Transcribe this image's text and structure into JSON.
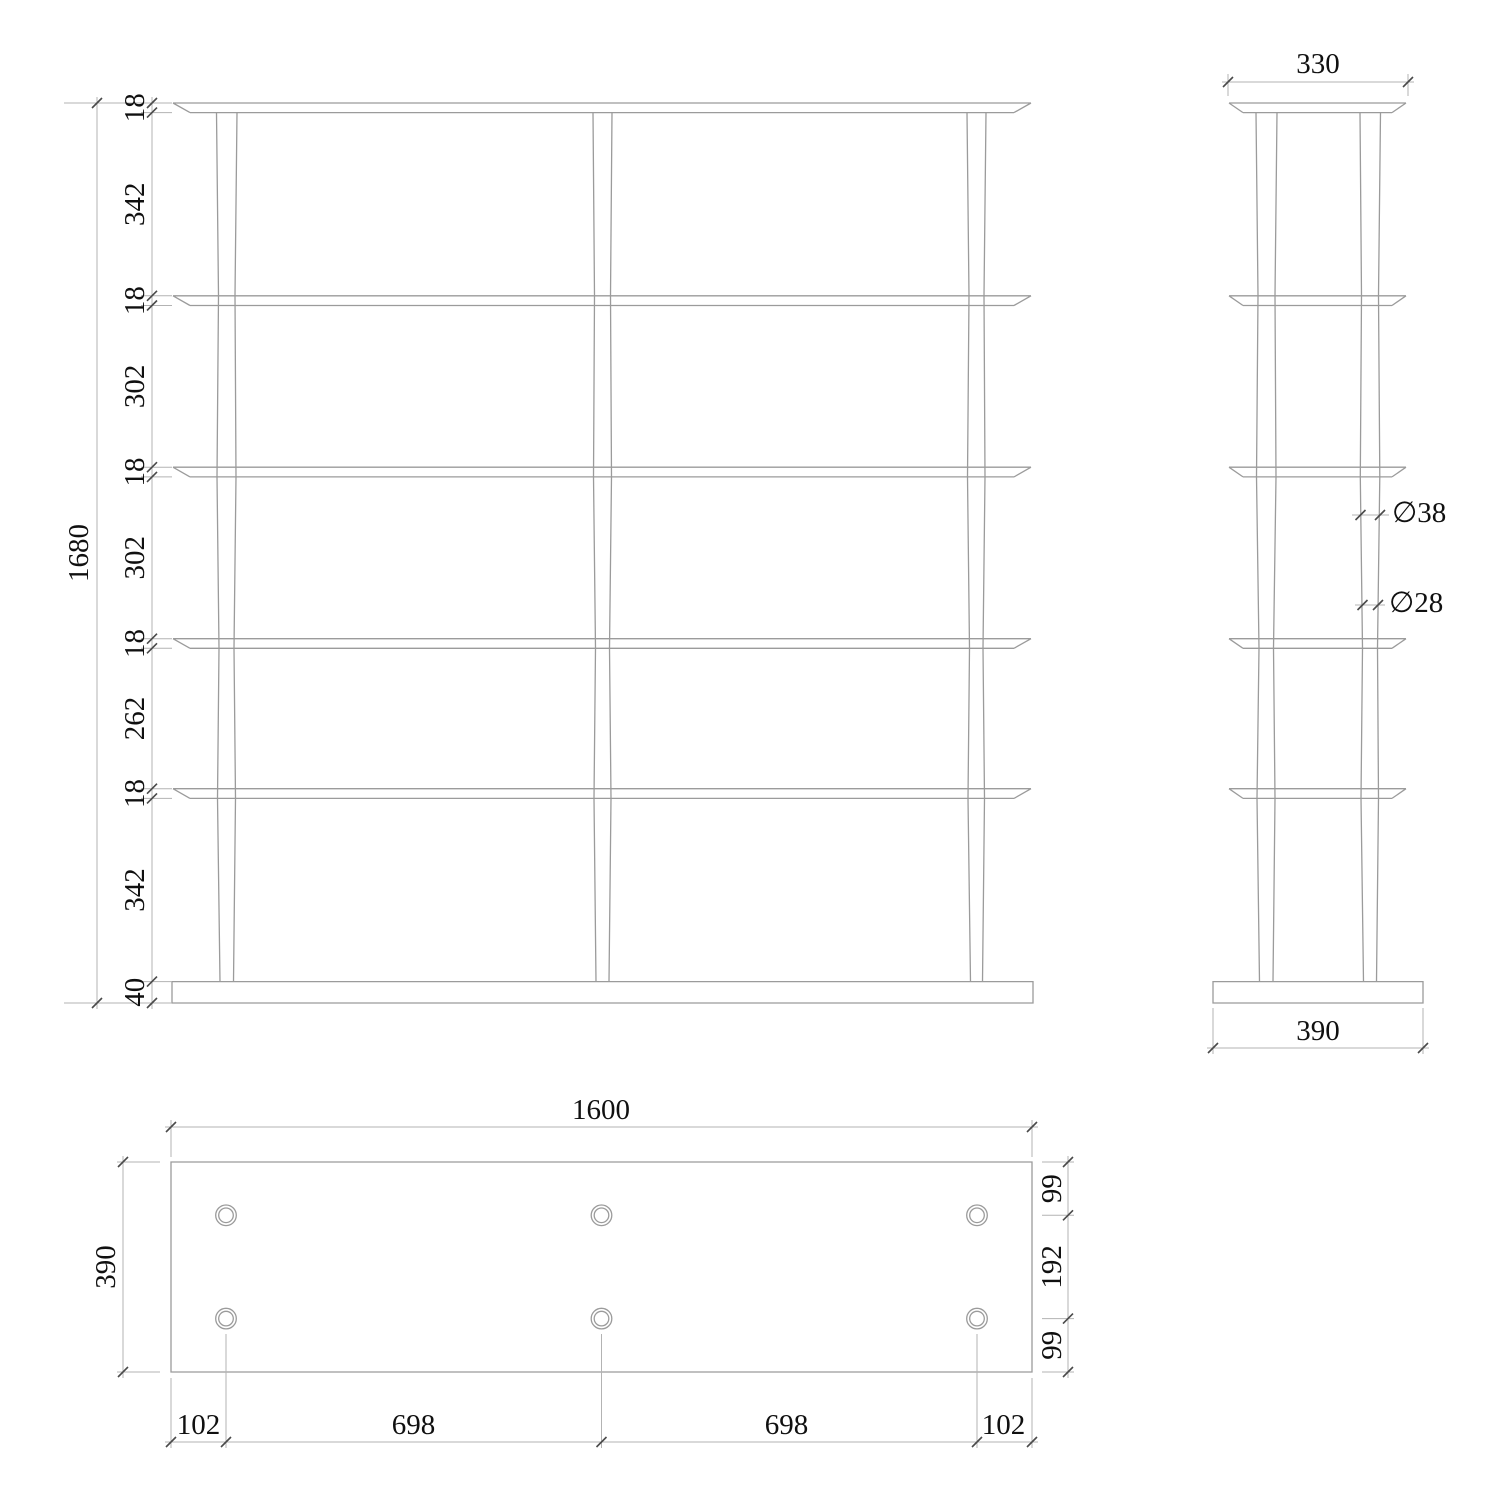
{
  "colors": {
    "background": "#ffffff",
    "object_line": "#9b9b9b",
    "dimension_line": "#b3b3b3",
    "tick": "#4a4a4a",
    "text": "#101010"
  },
  "front_view": {
    "overall_height": "1680",
    "height_chain": [
      "18",
      "342",
      "18",
      "302",
      "18",
      "302",
      "18",
      "262",
      "18",
      "342",
      "40"
    ]
  },
  "side_view": {
    "top_width": "330",
    "base_width": "390",
    "leg_upper_diameter": "∅38",
    "leg_lower_diameter": "∅28"
  },
  "plan_view": {
    "overall_width": "1600",
    "overall_depth": "390",
    "depth_chain": [
      "99",
      "192",
      "99"
    ],
    "width_chain": [
      "102",
      "698",
      "698",
      "102"
    ]
  }
}
